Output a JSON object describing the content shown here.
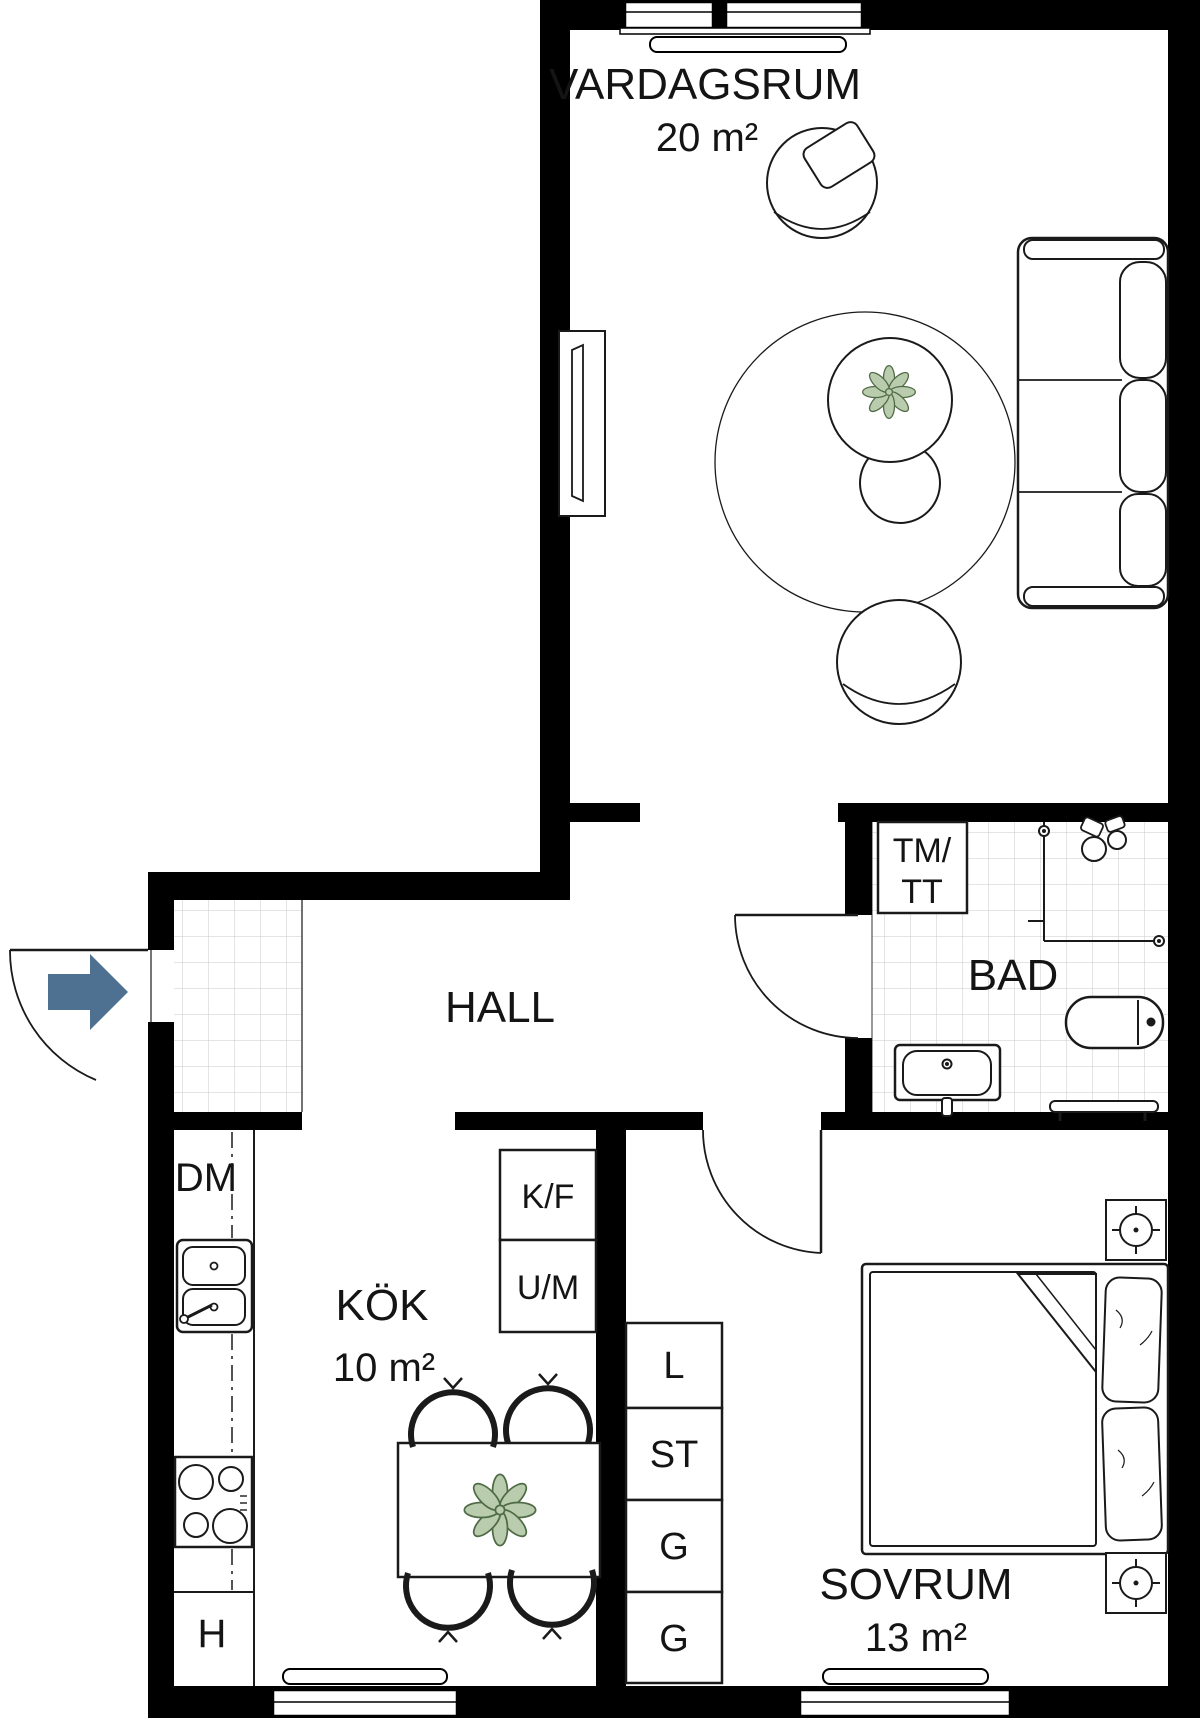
{
  "rooms": {
    "vardagsrum": {
      "label": "VARDAGSRUM",
      "area": "20 m²"
    },
    "hall": {
      "label": "HALL"
    },
    "bad": {
      "label": "BAD"
    },
    "kok": {
      "label": "KÖK",
      "area": "10 m²"
    },
    "sovrum": {
      "label": "SOVRUM",
      "area": "13 m²"
    }
  },
  "appliances": {
    "dishwasher": "DM",
    "fridge_freezer": "K/F",
    "oven_microwave": "U/M",
    "washer_line1": "TM/",
    "washer_line2": "TT",
    "hatch": "H"
  },
  "closets": [
    "L",
    "ST",
    "G",
    "G"
  ],
  "colors": {
    "wall": "#000000",
    "entry_arrow": "#4e7191",
    "plant_fill": "#b9ccae",
    "plant_stroke": "#4f6b45",
    "tile_line": "#c9c9c9"
  }
}
